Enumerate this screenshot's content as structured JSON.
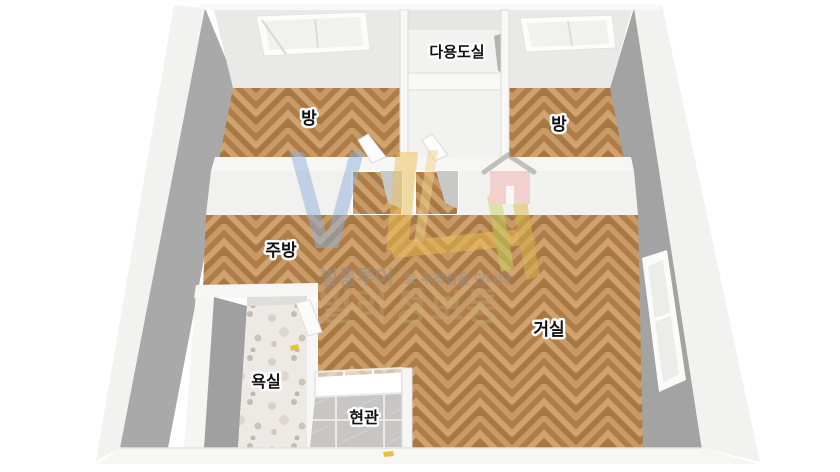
{
  "image": {
    "width": 840,
    "height": 472,
    "background": "#ffffff",
    "type": "3d-floorplan-render"
  },
  "floorplan": {
    "rooms": [
      {
        "id": "bedroom-left",
        "label": "방"
      },
      {
        "id": "utility-room",
        "label": "다용도실"
      },
      {
        "id": "bedroom-right",
        "label": "방"
      },
      {
        "id": "kitchen",
        "label": "주방"
      },
      {
        "id": "living-room",
        "label": "거실"
      },
      {
        "id": "bathroom",
        "label": "욕실"
      },
      {
        "id": "entrance",
        "label": "현관"
      }
    ],
    "colors": {
      "floor_wood_base": "#b98753",
      "floor_wood_1": "#c79a68",
      "floor_wood_2": "#b07d48",
      "floor_wood_3": "#cfa471",
      "floor_wood_4": "#a87844",
      "terrazzo_base": "#edeae6",
      "entrance_tile": "#c7c6c4",
      "wall_face": "#e9e9e8",
      "wall_top": "#f6f6f5",
      "wall_front": "#f1f1f0",
      "wall_side_gray": "#a9a9a9",
      "wall_side_gray_right": "#a3a3a3",
      "wall_inner_gray": "#a0a0a0",
      "label_text": "#111111",
      "label_halo": "#ffffff",
      "door_accent_yellow": "#e4c53a"
    },
    "watermark": {
      "tagline_strong": "빌통투어",
      "tagline_rest": "로 우리집을 만나다",
      "brand": "빌라정보통",
      "colors": {
        "blue": "#8fb0dc",
        "yellow": "#eec154",
        "yellow_light": "#f1d488",
        "yellow_dark": "#d9b84a",
        "green": "#c9d65f",
        "house_pink": "#f2b1ab",
        "roof_gray": "#8a8a8a",
        "tagline": "#8f8f8f",
        "brand_tan": "#c8a87e"
      }
    }
  }
}
